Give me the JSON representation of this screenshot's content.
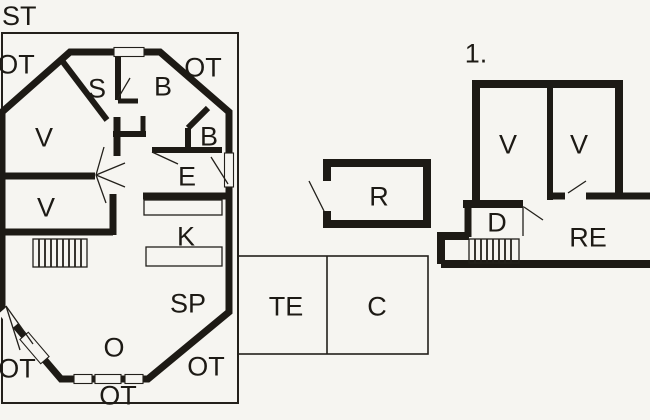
{
  "colors": {
    "background": "#f6f5f1",
    "ink": "#1d1a15"
  },
  "ground_floor": {
    "name_label": "ST",
    "rooms": {
      "ot_top_left": "OT",
      "ot_top_right": "OT",
      "s": "S",
      "b_large": "B",
      "b_small": "B",
      "v_upper": "V",
      "v_lower": "V",
      "e": "E",
      "k": "K",
      "sp": "SP",
      "o": "O",
      "ot_bottom_left": "OT",
      "ot_bottom_right": "OT",
      "ot_bottom_center": "OT"
    }
  },
  "outbuildings": {
    "r": "R",
    "te": "TE",
    "c": "C"
  },
  "first_floor": {
    "name_label": "1.",
    "rooms": {
      "v_left": "V",
      "v_right": "V",
      "d": "D",
      "re": "RE"
    }
  }
}
